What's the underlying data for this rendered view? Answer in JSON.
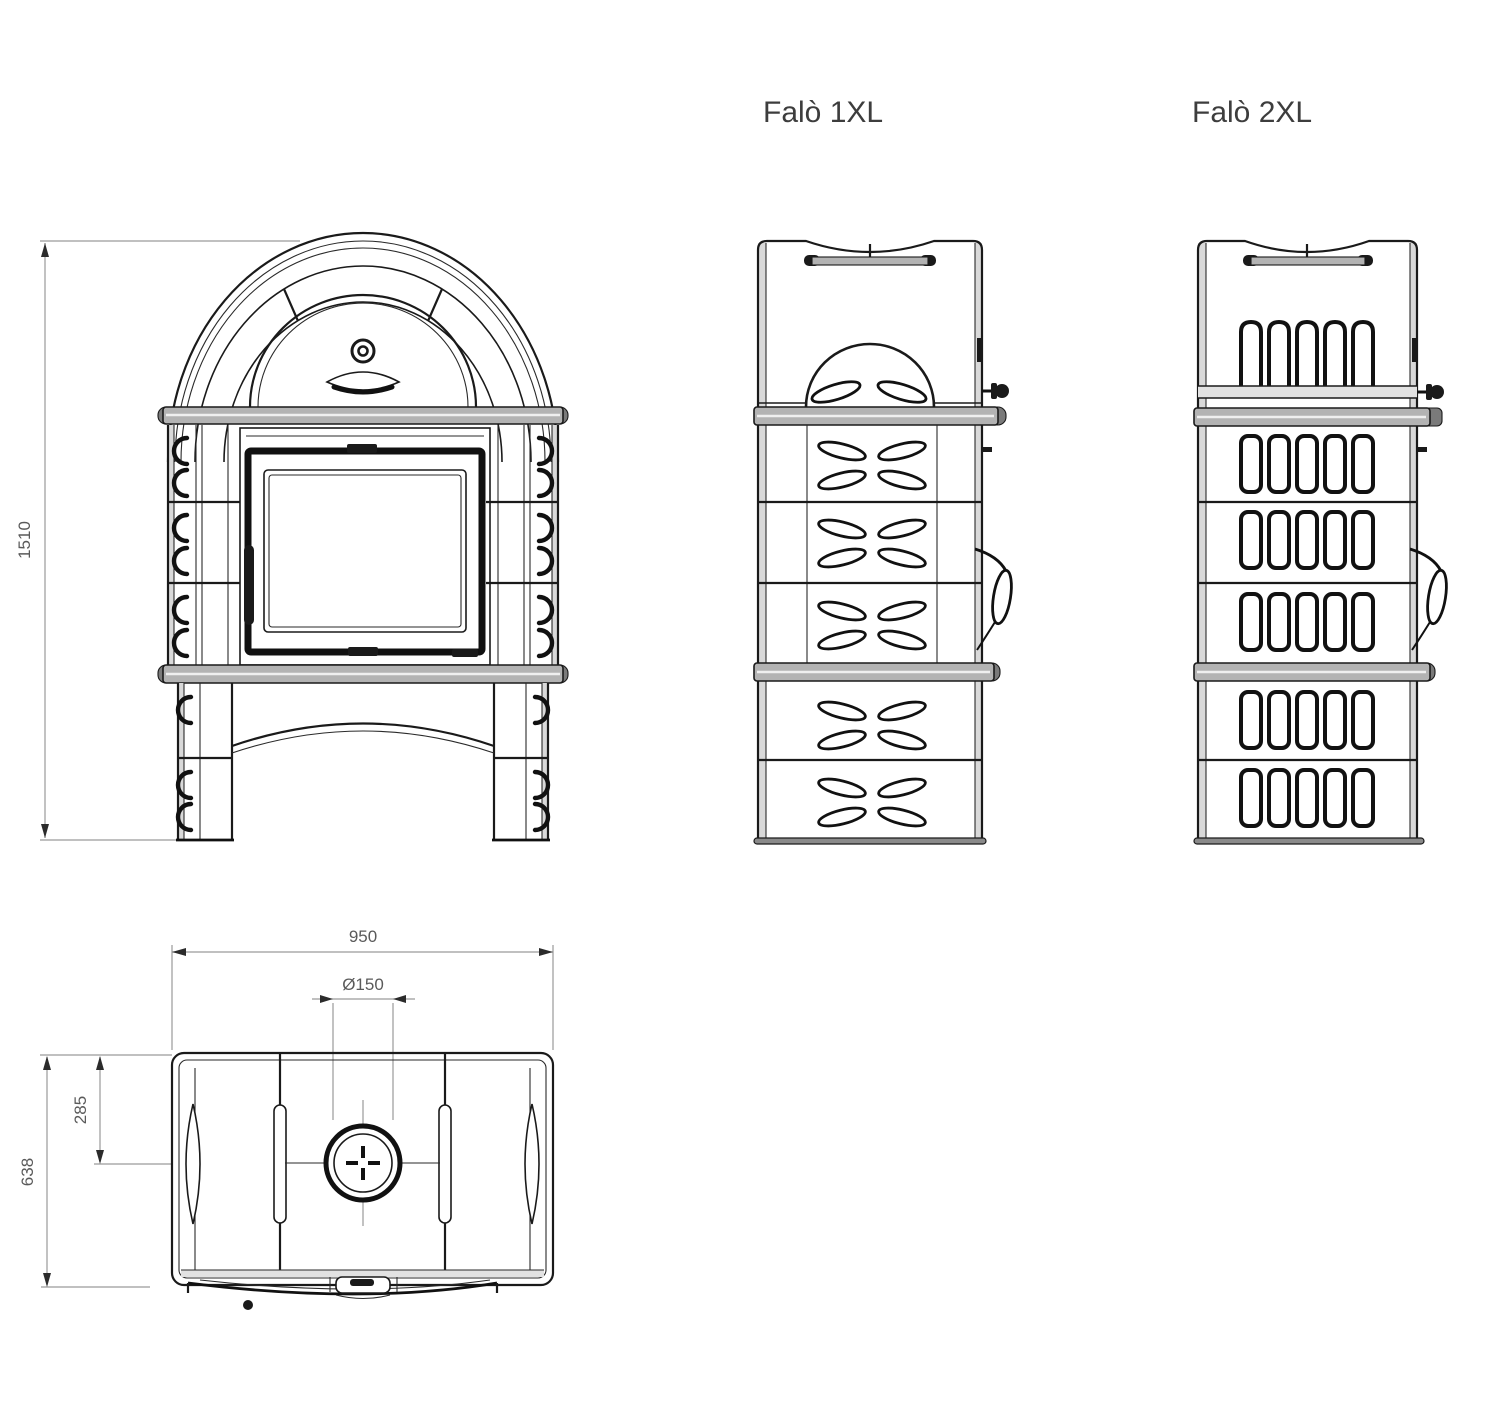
{
  "document": {
    "type": "technical-drawing",
    "subject": "tiled wood-burning stove, three orthographic views plus top plan view",
    "background_color": "#ffffff",
    "line_color": "#1a1a1a",
    "dimension_line_color": "#9a9a9a",
    "shelf_fill_color": "#b3b3b3",
    "label_color": "#3d3d3d"
  },
  "labels": {
    "model_1": "Falò 1XL",
    "model_2": "Falò 2XL"
  },
  "dimensions": {
    "overall_height": "1510",
    "overall_width": "950",
    "flue_diameter": "Ø150",
    "flue_offset_from_front": "285",
    "overall_depth": "638"
  },
  "views": {
    "front": "front view with arched top, glass door, two shelves and arched legs",
    "side_1xl": "side view Falò 1XL with leaf-relief tiles",
    "side_2xl": "side view Falò 2XL with slotted tiles",
    "top": "top plan view with flue collar"
  }
}
